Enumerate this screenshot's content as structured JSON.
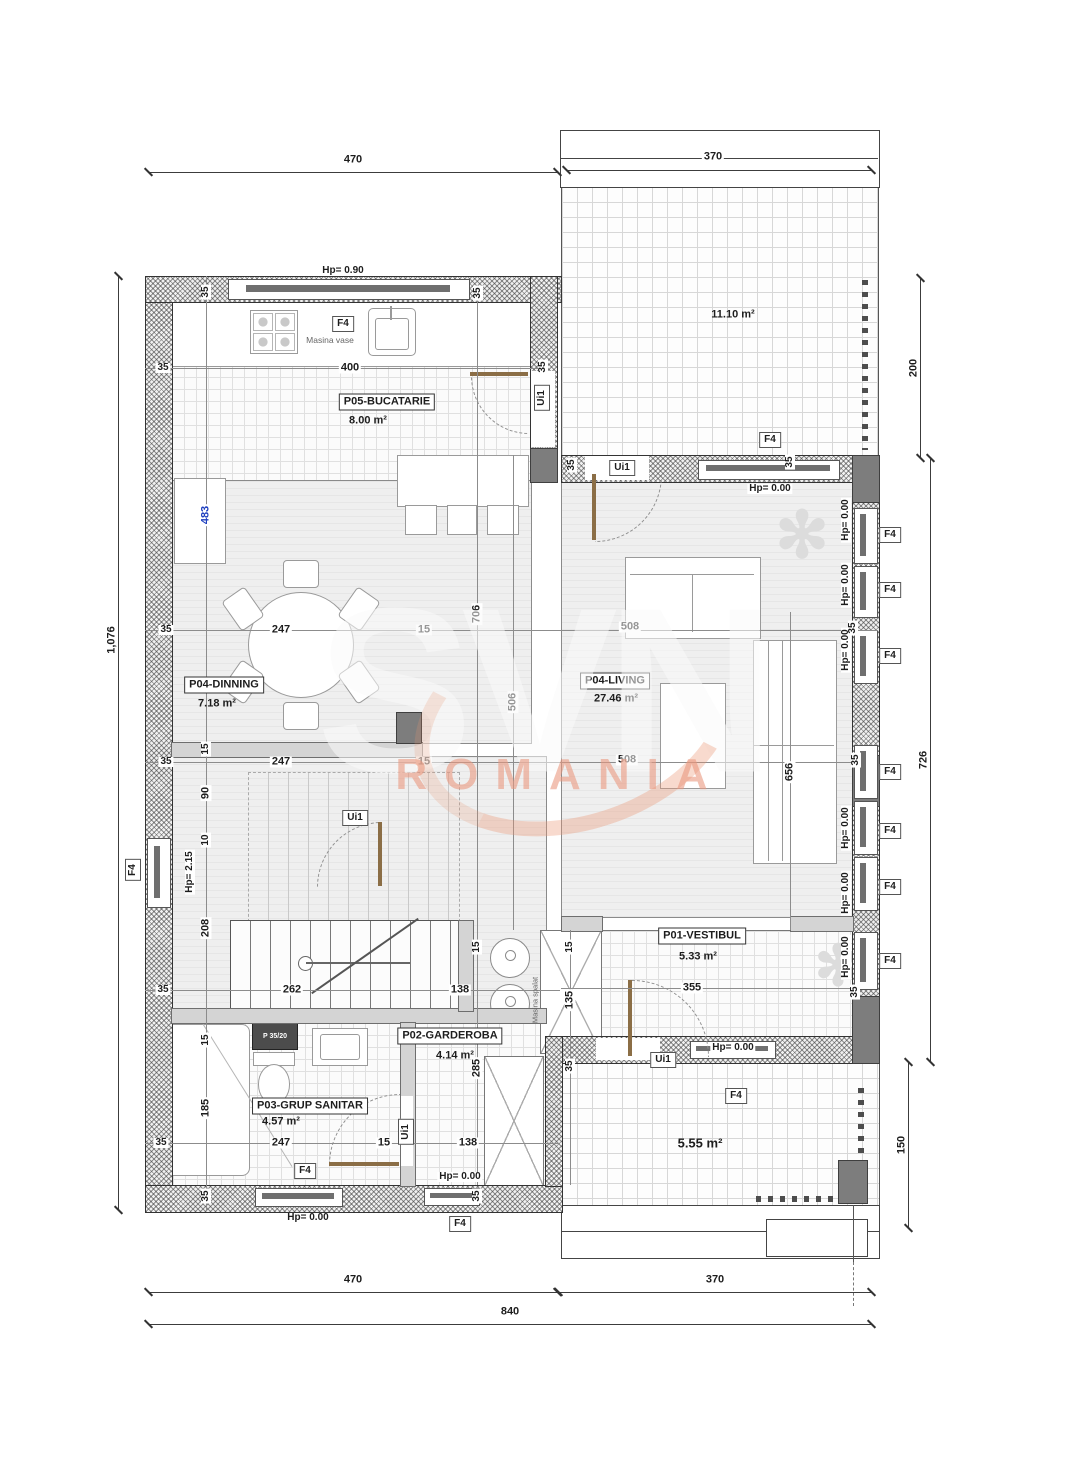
{
  "watermark": {
    "brand": "SVN",
    "region": "ROMANIA"
  },
  "rooms": [
    {
      "name": "P05-BUCATARIE",
      "area": "8.00 m²"
    },
    {
      "name": "P04-DINNING",
      "area": "7.18 m²"
    },
    {
      "name": "P04-LIVING",
      "area": "27.46 m²"
    },
    {
      "name": "P01-VESTIBUL",
      "area": "5.33 m²"
    },
    {
      "name": "P02-GARDEROBA",
      "area": "4.14 m²"
    },
    {
      "name": "P03-GRUP SANITAR",
      "area": "4.57 m²"
    }
  ],
  "outdoor": {
    "terrace_upper": "11.10 m²",
    "terrace_lower": "5.55 m²"
  },
  "tags": {
    "door": "Ui1",
    "window": "F4"
  },
  "levels": {
    "hp_090": "Hp= 0.90",
    "hp_000": "Hp= 0.00",
    "hp_215": "Hp= 2.15"
  },
  "appliances": {
    "dishwasher": "Masina vase",
    "washer": "Masina spalat",
    "shower_unit": "P 35/20"
  },
  "icons": {
    "plant": "✻"
  },
  "dims": {
    "d470": "470",
    "d370": "370",
    "d840": "840",
    "d1076": "1,076",
    "d200": "200",
    "d726": "726",
    "d150": "150",
    "d400": "400",
    "d483": "483",
    "d706": "706",
    "d506": "506",
    "d508": "508",
    "d656": "656",
    "d247": "247",
    "d262": "262",
    "d208": "208",
    "d185": "185",
    "d138": "138",
    "d135": "135",
    "d285": "285",
    "d355": "355",
    "d90": "90",
    "d35": "35",
    "d15": "15",
    "d10": "10"
  }
}
